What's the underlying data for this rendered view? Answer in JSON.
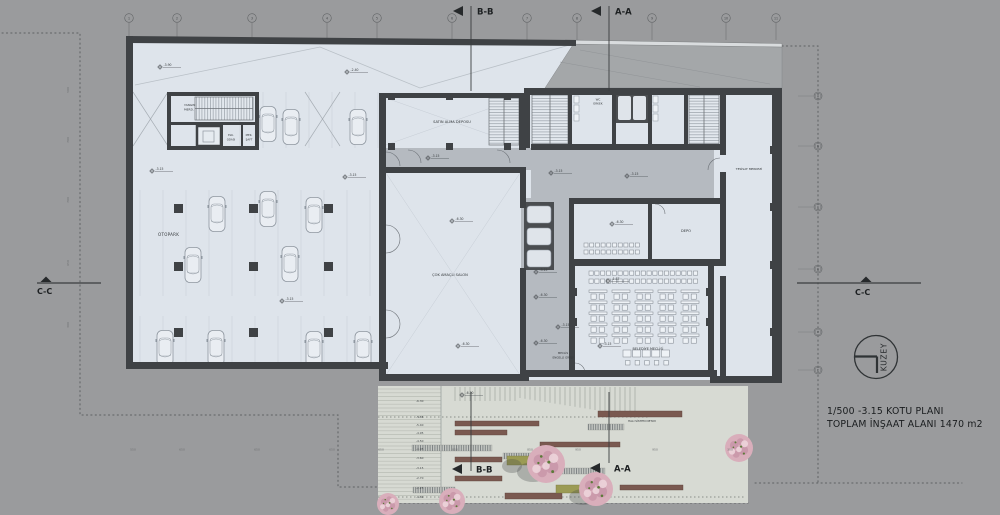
{
  "title": {
    "line1": "1/500 -3.15 KOTU  PLANI",
    "line2": "TOPLAM İNŞAAT ALANI 1470 m2"
  },
  "compass": {
    "label": "KUZEY"
  },
  "sections": {
    "bb": "B-B",
    "aa": "A-A",
    "cc": "C-C"
  },
  "grid": {
    "columns": [
      "1",
      "2",
      "3",
      "4",
      "5",
      "6",
      "7",
      "8",
      "9",
      "10",
      "11"
    ],
    "rows": [
      "A",
      "B",
      "C",
      "D",
      "E",
      "F"
    ]
  },
  "rooms": {
    "otopark": "OTOPARK",
    "satin_alma": "SATIN ALMA DEPOSU",
    "cok_amacli": "ÇOK AMAÇLI SALON",
    "wc_line1": "WC",
    "wc_line2": "ERKEK",
    "tesisat": "TESİSAT MERKEZİ",
    "depo": "DEPO",
    "meclis": "BELEDİYE MECLİSİ",
    "engelli_1": "MECLİS",
    "engelli_2": "ENGELLİ GİRİŞİ",
    "yangin_1": "YANGIN",
    "yangin_2": "MERD.",
    "elk_1": "ELK.",
    "elk_2": "ODASI",
    "mek_1": "MEK.",
    "mek_2": "ŞAFT"
  },
  "notes": {
    "detail": "HALI SİSTEM DETAYI"
  },
  "elevation_markers": [
    "-3.90",
    "-2.40",
    "-3.15",
    "-3.15",
    "-3.15",
    "-3.15",
    "-3.15",
    "-3.15",
    "-6.30",
    "-6.30",
    "-6.30",
    "-1.87",
    "-3.15",
    "-3.15",
    "-6.30",
    "-3.15",
    "-6.30",
    "-6.30"
  ],
  "landscape": {
    "elevation_labels": [
      "-6.30",
      "-5.85",
      "-5.40",
      "-4.95",
      "-4.50",
      "-4.05",
      "-3.60",
      "-3.15",
      "-2.70",
      "-2.25",
      "-1.80"
    ]
  },
  "dimensions": {
    "bottom": [
      "550",
      "650",
      "650",
      "650",
      "650",
      "850",
      "850",
      "950",
      "950",
      "300"
    ],
    "left": [
      "500",
      "700",
      "700",
      "650",
      "300"
    ]
  },
  "colors": {
    "background": "#9a9b9d",
    "wall": "#3f4245",
    "interior": "#dee4eb",
    "circulation": "#b5bac0",
    "canopy": "#a4a7a9",
    "landscape": "#d7dad3",
    "planter": "#7a5950",
    "hedge": "#9b9b54",
    "tree": "#dcb0be",
    "ink": "#26292b"
  }
}
